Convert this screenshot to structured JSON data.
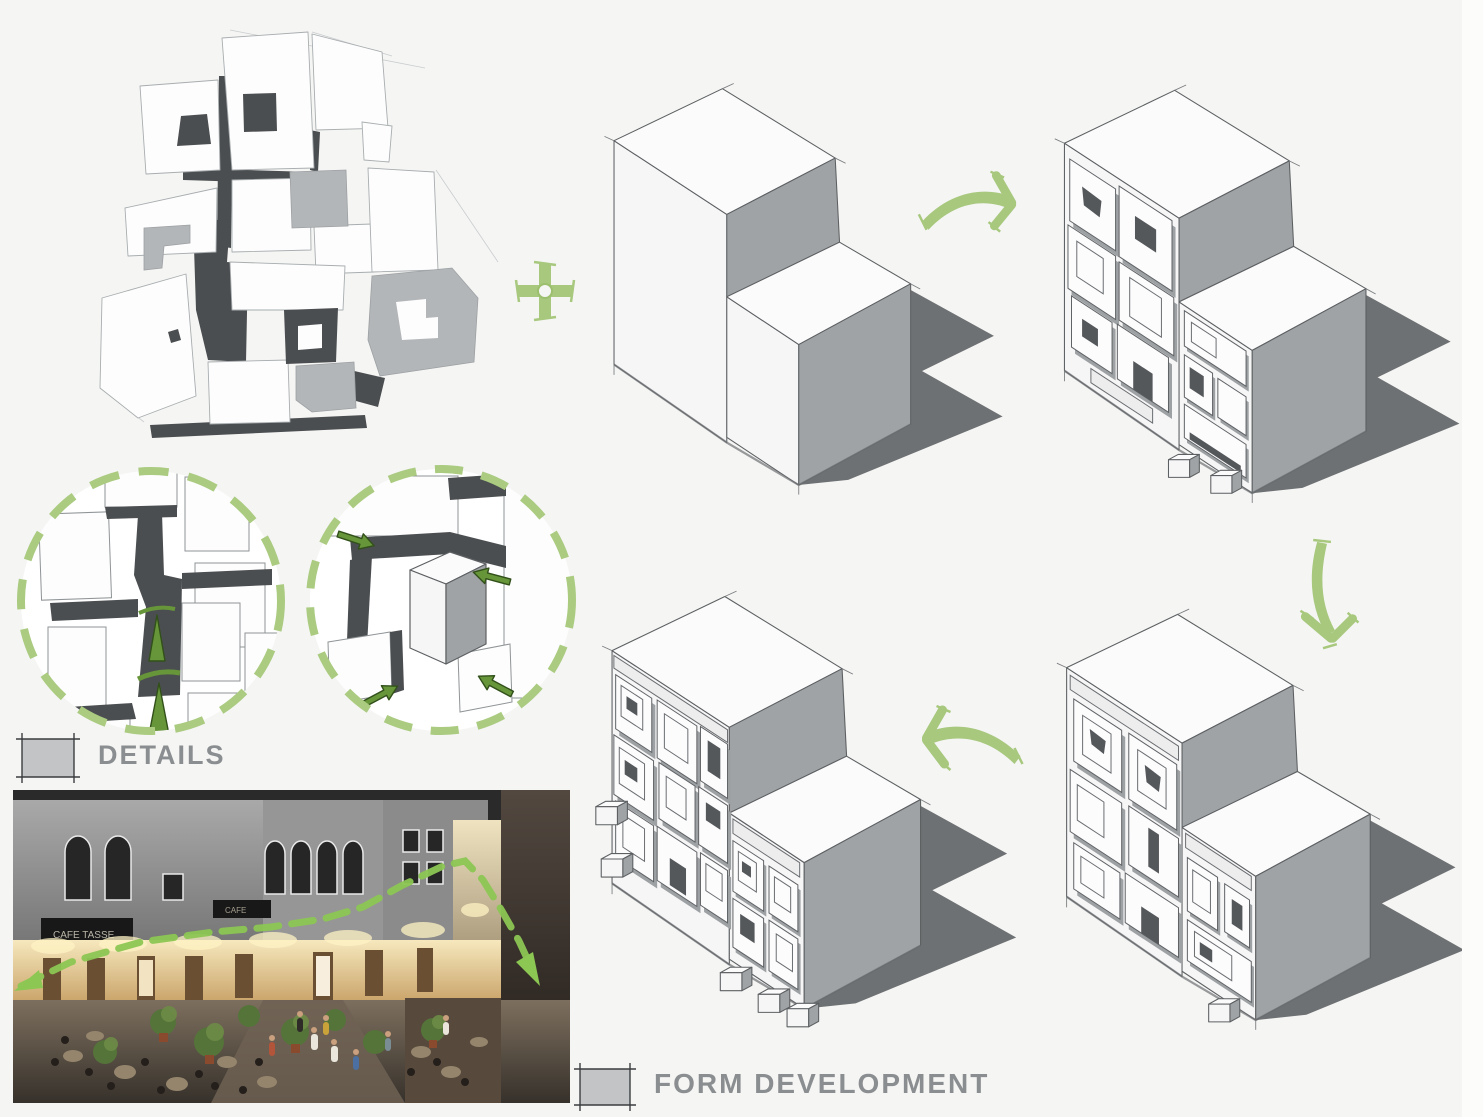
{
  "board": {
    "title_visible_text_only": true,
    "background": "#f5f5f4",
    "accent_green": "#a7c87d",
    "dark_green": "#679539",
    "sketch_dark": "#4b4e50",
    "panel_shade_gray": "#9ea1a3",
    "cast_shadow_gray": "#6e7173",
    "label_color": "#8b8e90"
  },
  "labels": {
    "details": "DETAILS",
    "form_development": "FORM DEVELOPMENT"
  },
  "photo": {
    "sign_text": "CAFE TASSE",
    "sign_text_2": "CAFE"
  },
  "icons": {
    "plus": "plus-icon",
    "arrow_right": "arrow-right-icon",
    "arrow_down": "arrow-down-icon",
    "arrow_left": "arrow-left-icon",
    "detail_circle": "dashed-circle-icon",
    "flow_arrows_up": "up-flow-arrows-icon",
    "pressure_arrows": "inward-arrows-icon"
  }
}
